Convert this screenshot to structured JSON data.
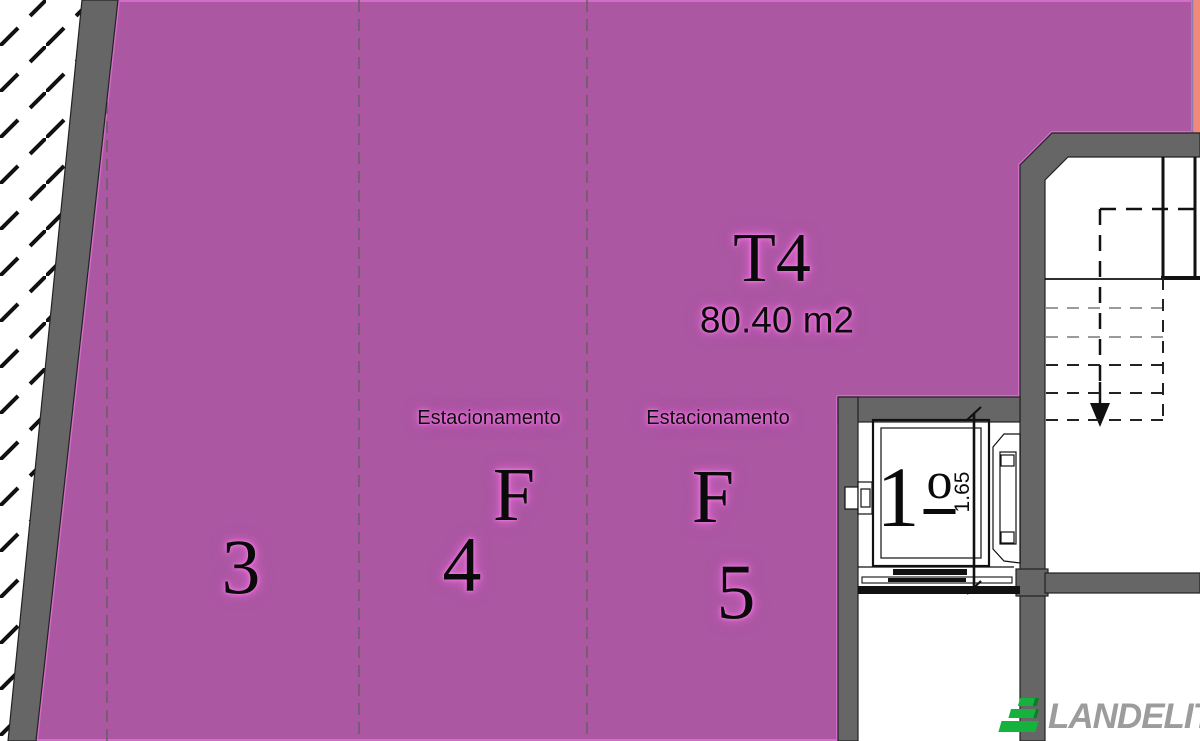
{
  "title_block": {
    "unit_type": "T4",
    "unit_area": "80.40 m2"
  },
  "parking_stalls": [
    {
      "number": "3"
    },
    {
      "number": "4",
      "label": "Estacionamento",
      "letter": "F"
    },
    {
      "number": "5",
      "label": "Estacionamento",
      "letter": "F"
    }
  ],
  "elevator": {
    "floor_number": "1",
    "floor_ordinal": "o",
    "dimension_label": "1.65"
  },
  "watermark": {
    "brand": "LANDELITY"
  },
  "colors": {
    "unit_fill": "#ab57a2",
    "unit_edge": "#d46cc9",
    "wall_gray": "#666666",
    "accent_salmon": "#ef8a7b",
    "text_glow": "#e365d2",
    "logo_green": "#15b33e",
    "logo_gray": "#9c9c9c"
  }
}
